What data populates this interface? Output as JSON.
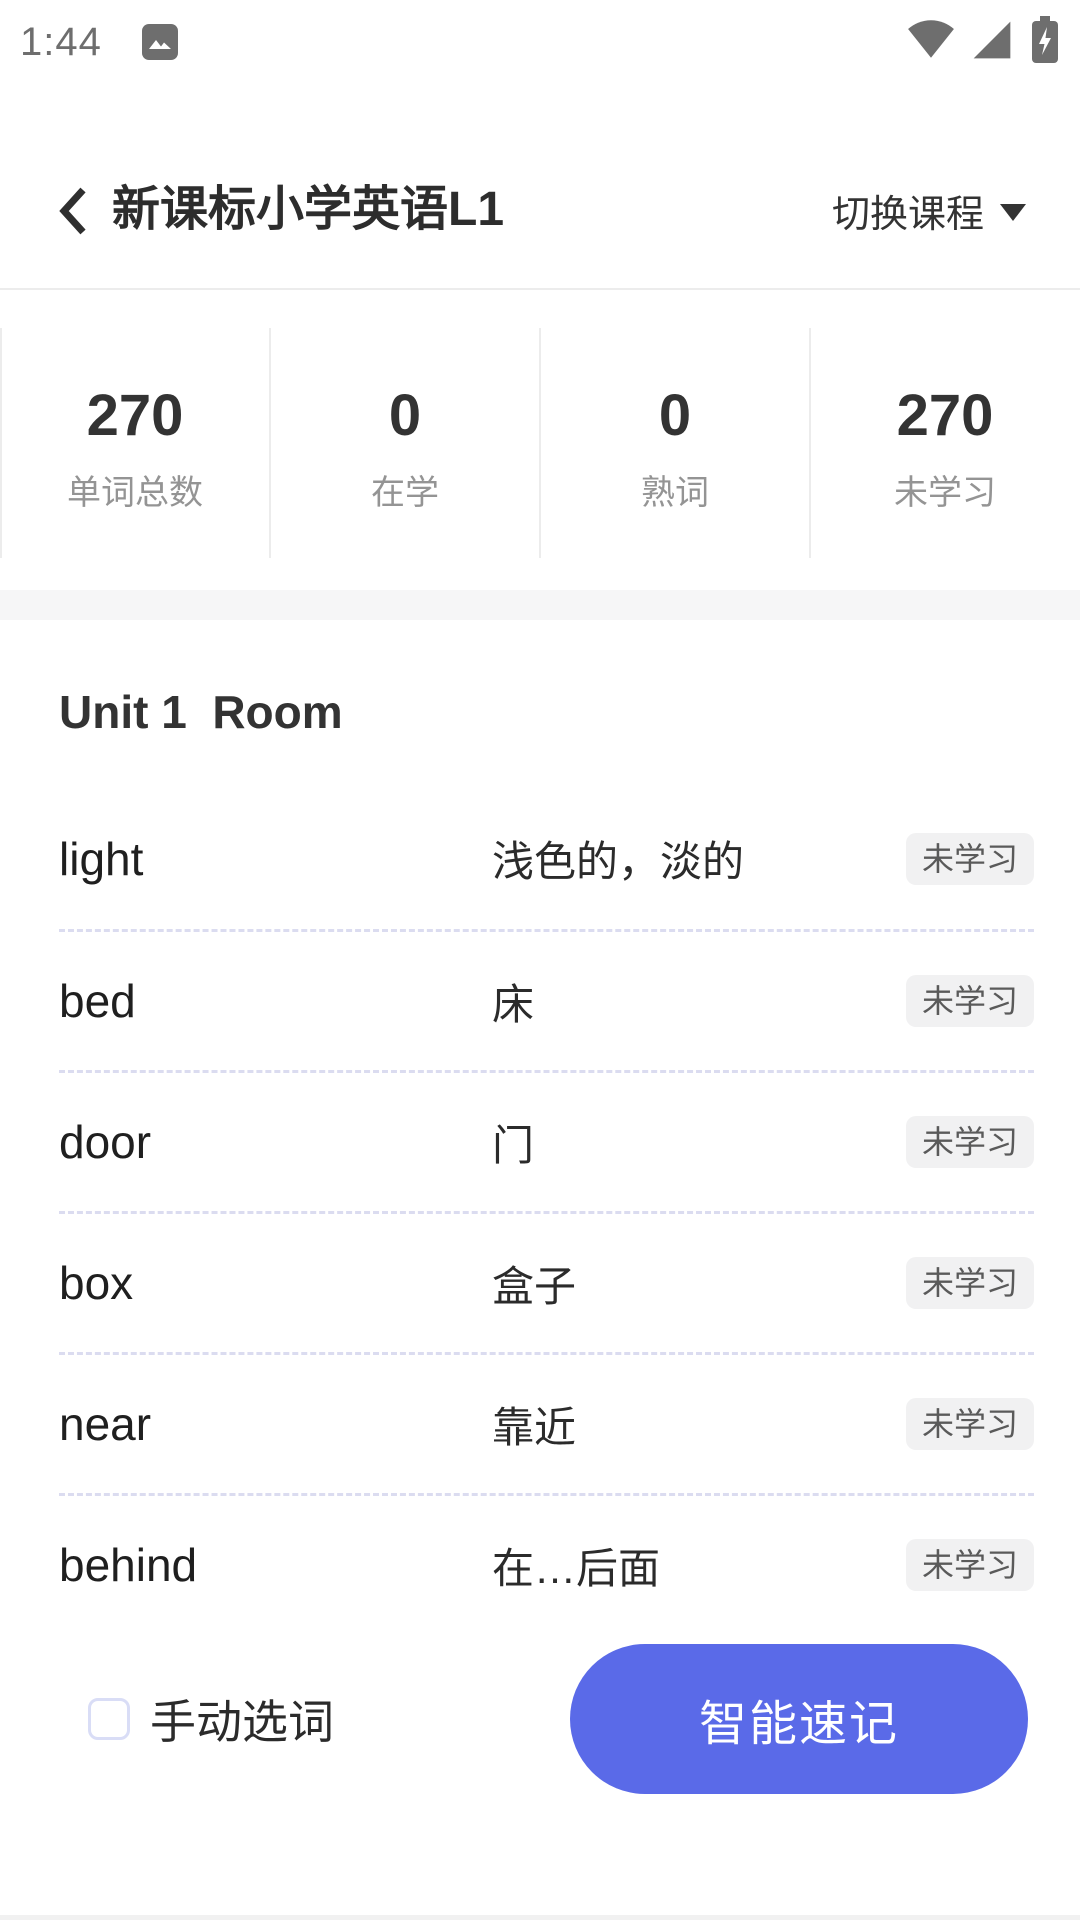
{
  "status_bar": {
    "time": "1:44"
  },
  "header": {
    "title": "新课标小学英语L1",
    "switch_course_label": "切换课程"
  },
  "stats": {
    "items": [
      {
        "value": "270",
        "label": "单词总数"
      },
      {
        "value": "0",
        "label": "在学"
      },
      {
        "value": "0",
        "label": "熟词"
      },
      {
        "value": "270",
        "label": "未学习"
      }
    ]
  },
  "unit": {
    "title": "Unit 1  Room"
  },
  "words": [
    {
      "word": "light",
      "meaning": "浅色的，淡的",
      "status": "未学习"
    },
    {
      "word": "bed",
      "meaning": "床",
      "status": "未学习"
    },
    {
      "word": "door",
      "meaning": "门",
      "status": "未学习"
    },
    {
      "word": "box",
      "meaning": "盒子",
      "status": "未学习"
    },
    {
      "word": "near",
      "meaning": "靠近",
      "status": "未学习"
    },
    {
      "word": "behind",
      "meaning": "在…后面",
      "status": "未学习"
    }
  ],
  "footer": {
    "manual_select_label": "手动选词",
    "smart_memorize_label": "智能速记"
  },
  "colors": {
    "accent": "#5a6ae8",
    "badge-bg": "#f1f1f2",
    "divider": "#dbdcf0",
    "band": "#f6f6f7",
    "statusbar": "#6e6e6e",
    "checkbox-border": "#d9ddf6"
  }
}
